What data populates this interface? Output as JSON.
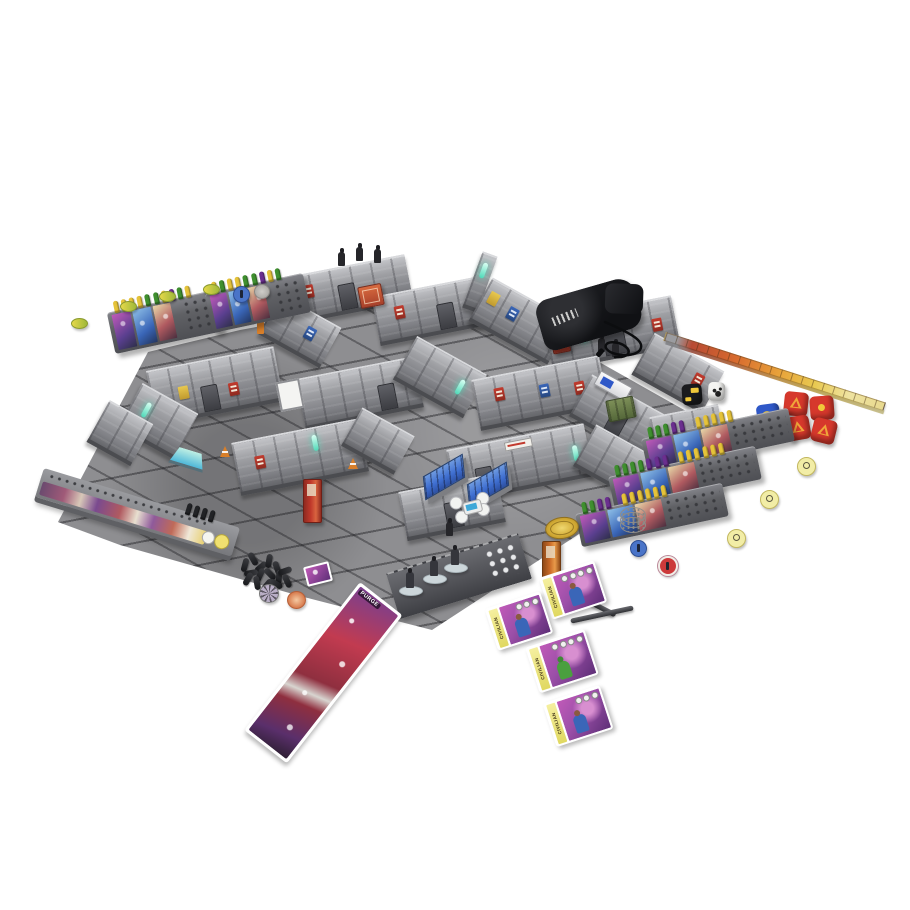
{
  "scene": {
    "type": "product-photo",
    "subject": "Sci-fi miniatures board game full setup: terrain board with modular walls, player dashboards, dice, tokens, cards, measuring rulers and dice bag on white background",
    "background": "#ffffff"
  },
  "labels": {
    "purge": "PURGE",
    "civilian": "CIVILIAN"
  },
  "colors": {
    "floor": "#8e8e91",
    "wall_light": "#c3c4c8",
    "wall_dark": "#55565a",
    "accent_red": "#c23b2e",
    "accent_blue": "#3a66b8",
    "accent_teal": "#4fd9b8",
    "bench_blue": "#3f6fd1",
    "machine_red": "#c0392b",
    "peg_yellow": "#e5c33a",
    "peg_green": "#3f8f2f",
    "peg_purple": "#6b2f8f",
    "dice_red": "#d6382c",
    "dice_blue": "#2f58c8",
    "dice_gold": "#f0c83a",
    "dice_orange": "#f0a63a",
    "token_yellow": "#f2eda6",
    "token_blue": "#4a74c8",
    "token_red": "#cc3a3a",
    "coin_gold": "#d0a832"
  },
  "peg_rows": {
    "supply1": [
      "y",
      "y",
      "y",
      "y",
      "g",
      "g",
      "y",
      "p",
      "g",
      "y"
    ],
    "supply2": [
      "y",
      "g",
      "y",
      "y",
      "g",
      "g",
      "p",
      "y",
      "g"
    ],
    "player1": [
      "g",
      "g",
      "g",
      "p",
      "p",
      "s",
      "y",
      "y",
      "y",
      "y",
      "y"
    ],
    "player2": [
      "g",
      "g",
      "g",
      "g",
      "p",
      "p",
      "p",
      "s",
      "y",
      "y",
      "y",
      "y",
      "y",
      "y"
    ],
    "player3": [
      "g",
      "g",
      "p",
      "p",
      "s",
      "y",
      "y",
      "y",
      "y",
      "y",
      "y"
    ],
    "tracker": [
      "k",
      "k",
      "k",
      "k"
    ]
  },
  "peg_pile": [
    [
      0,
      6,
      15
    ],
    [
      8,
      0,
      -30
    ],
    [
      16,
      8,
      50
    ],
    [
      24,
      2,
      10
    ],
    [
      32,
      9,
      -20
    ],
    [
      6,
      14,
      80
    ],
    [
      15,
      16,
      25
    ],
    [
      25,
      15,
      -45
    ],
    [
      34,
      18,
      5
    ],
    [
      12,
      24,
      -10
    ],
    [
      22,
      26,
      40
    ],
    [
      31,
      25,
      -60
    ],
    [
      3,
      20,
      30
    ],
    [
      40,
      12,
      70
    ],
    [
      42,
      22,
      -25
    ]
  ],
  "counts": {
    "red_dice": 4,
    "blue_dice": 1,
    "black_dice": 1,
    "white_dice": 1,
    "player_dashboards": 3,
    "supply_boards": 2,
    "civilian_cards": 4,
    "yellow_round_tokens": 3,
    "oval_tokens": 4,
    "crew_miniatures_on_strip": 3,
    "rooftop_miniatures": 3
  }
}
